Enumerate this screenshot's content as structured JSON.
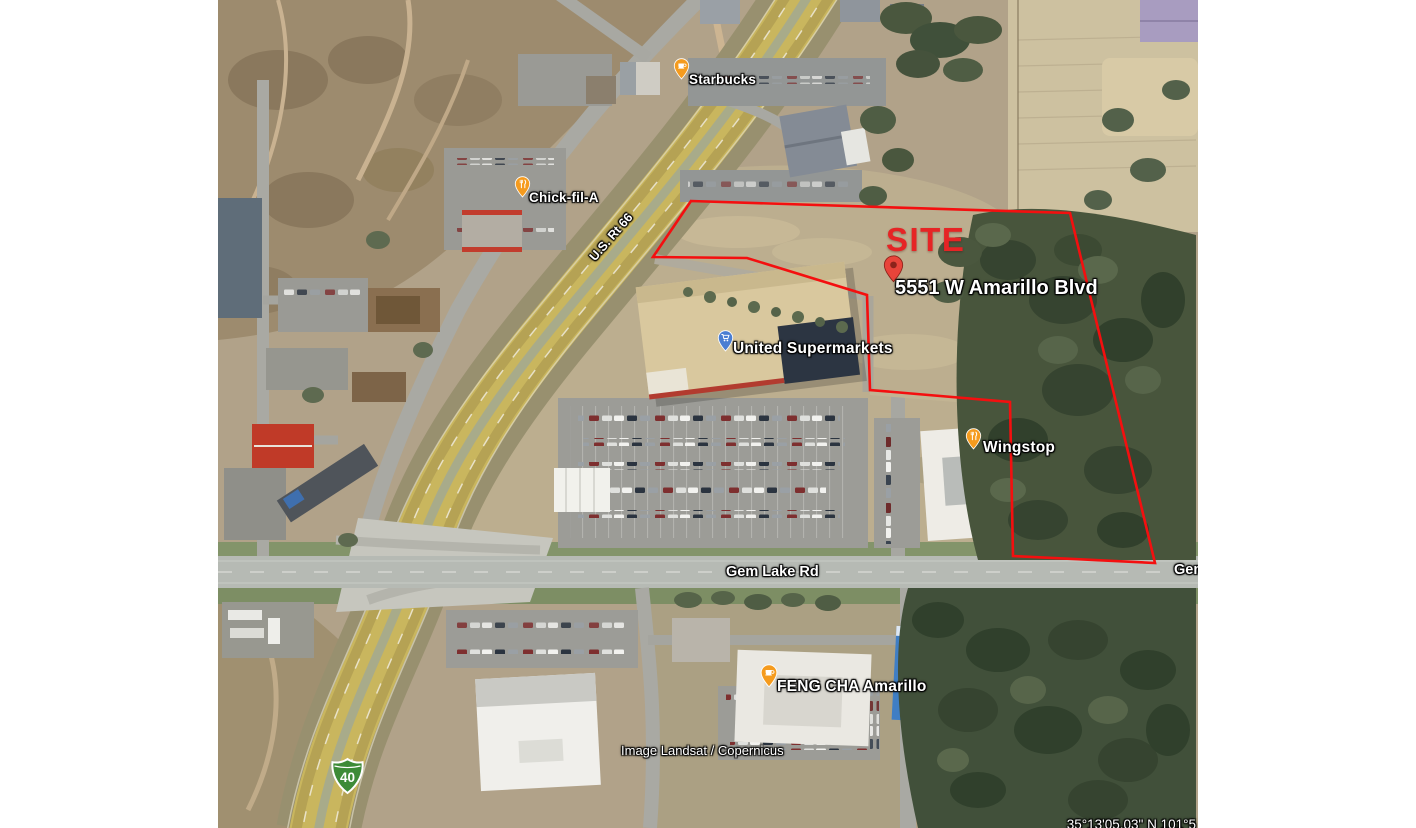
{
  "map": {
    "imagery_type": "satellite",
    "attribution": "Image Landsat / Copernicus",
    "coordinates_readout": "35°13'05.03\" N  101°5"
  },
  "site": {
    "label": "SITE",
    "label_color": "#e62425",
    "address": "5551 W Amarillo Blvd",
    "boundary_color": "#f40f0f",
    "pin_color": "#e8443a",
    "polygon_points": "473,201 852,213 937,563 795,556 792,402 652,390 649,295 529,258 435,257"
  },
  "roads": {
    "highway_label": "U.S. Rt 66",
    "cross_street_label": "Gem Lake Rd",
    "cross_street_label_right": "Gem Lake Rd",
    "interstate_shield_number": "40",
    "interstate_shield_color": "#3d8b37"
  },
  "places": [
    {
      "name": "Starbucks",
      "icon": "coffee-cup",
      "pin_color": "#f59b1e"
    },
    {
      "name": "Chick-fil-A",
      "icon": "restaurant",
      "pin_color": "#f59b1e"
    },
    {
      "name": "United Supermarkets",
      "icon": "shopping-cart",
      "pin_color": "#4a7ed2"
    },
    {
      "name": "Wingstop",
      "icon": "restaurant",
      "pin_color": "#f59b1e"
    },
    {
      "name": "FENG CHA Amarillo",
      "icon": "coffee-cup",
      "pin_color": "#f59b1e"
    }
  ]
}
